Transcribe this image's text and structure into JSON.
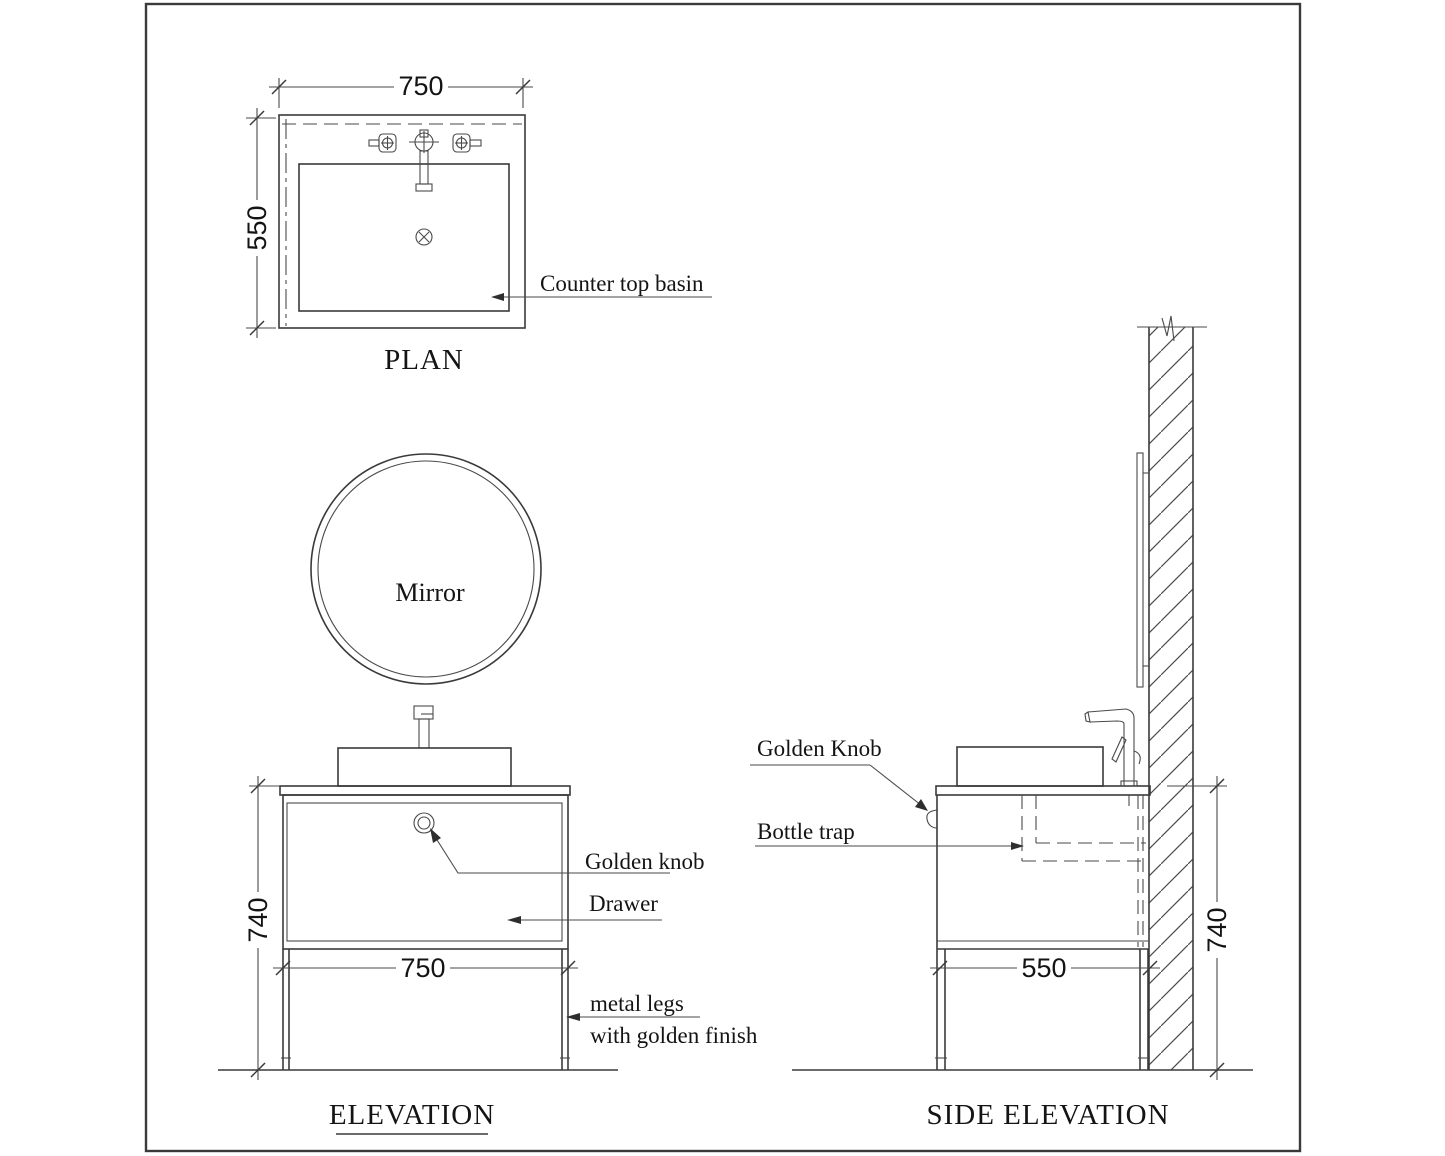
{
  "drawing": {
    "plan": {
      "title": "PLAN",
      "dim_width": "750",
      "dim_depth": "550",
      "basin_label": "Counter top basin"
    },
    "elevation": {
      "title": "ELEVATION",
      "mirror_label": "Mirror",
      "knob_label": "Golden knob",
      "drawer_label": "Drawer",
      "legs_label_line1": "metal legs",
      "legs_label_line2": "with golden finish",
      "dim_width": "750",
      "dim_height": "740"
    },
    "side_elevation": {
      "title": "SIDE ELEVATION",
      "knob_label": "Golden Knob",
      "trap_label": "Bottle trap",
      "dim_depth": "550",
      "dim_height": "740"
    },
    "colors": {
      "line": "#3a3a3a",
      "text": "#141414"
    }
  }
}
